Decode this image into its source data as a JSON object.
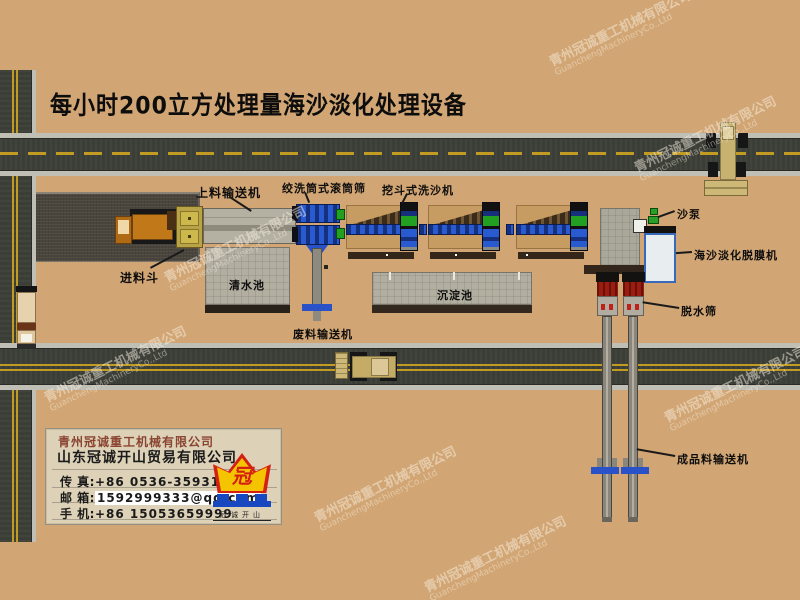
{
  "title": "每小时200立方处理量海沙淡化处理设备",
  "equipment_labels": {
    "feed_conveyor": "上料输送机",
    "drum_washer": "绞洗筒式滚筒筛",
    "bucket_washer": "挖斗式洗沙机",
    "sand_pump": "沙泵",
    "desalination_machine": "海沙淡化脱膜机",
    "dewatering_screen": "脱水筛",
    "feed_hopper": "进料斗",
    "clean_water_pool": "清水池",
    "sediment_pool": "沉淀池",
    "waste_conveyor": "废料输送机",
    "product_conveyor": "成品料输送机"
  },
  "company_card": {
    "company1": "青州冠诚重工机械有限公司",
    "company2": "山东冠诚开山贸易有限公司",
    "fax_label": "传  真:",
    "fax_value": "+86 0536-3593111",
    "email_label": "邮  箱:",
    "email_value": "1592999333@qq.com",
    "mobile_label": "手  机:",
    "mobile_value": "+86 15053659999",
    "logo_char": "冠",
    "logo_caption": "冠诚开山"
  },
  "watermark": {
    "cn": "青州冠诚重工机械有限公司",
    "en": "GuanchengMachineryCo.,Ltd"
  },
  "colors": {
    "background": "#d2a674",
    "road": "#3b3e36",
    "road_line_yellow": "#c19b22",
    "machine_blue": "#2a5ad0",
    "machine_green": "#22a022",
    "logo_yellow": "#f5c400",
    "logo_red": "#d42010",
    "logo_blue": "#1848c0"
  }
}
